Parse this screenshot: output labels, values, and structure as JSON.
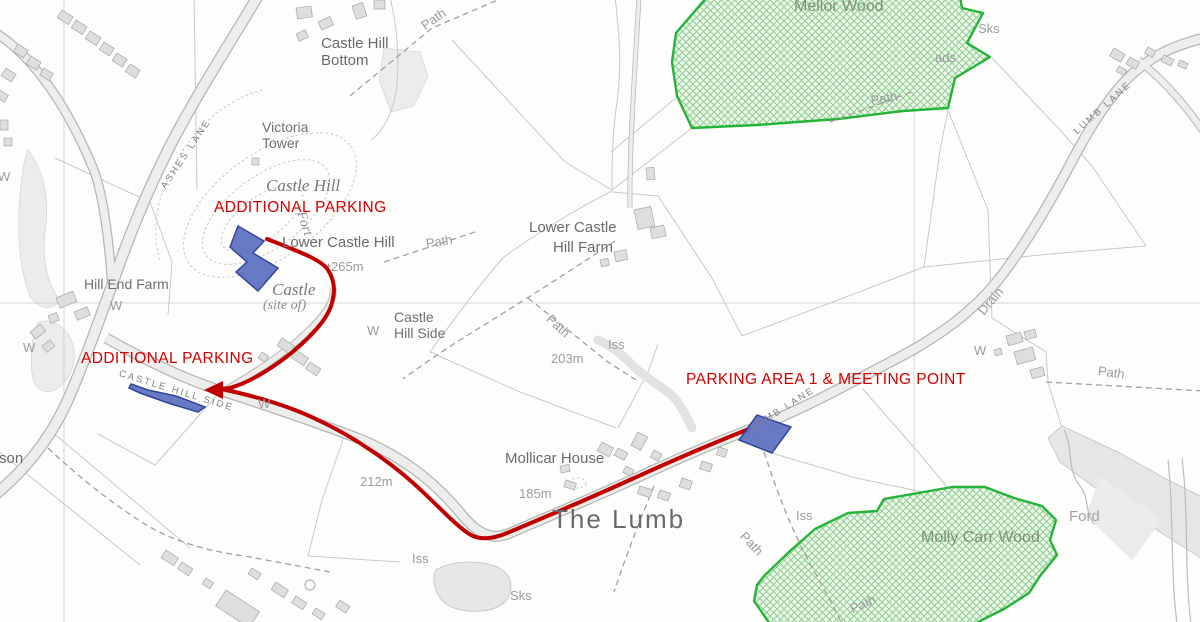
{
  "map": {
    "description": "OS-style walking map with marked parking areas and route",
    "colors": {
      "route_red": "#c00000",
      "annotation_red": "#d20000",
      "parking_fill": "#6273c2",
      "parking_stroke": "#2c3c96",
      "wood_border": "#25b33a",
      "wood_fill": "#e4f3dd",
      "wood_hatch": "#7ec983",
      "wood_text": "#7d917d",
      "road_casing": "#b5b5b3",
      "road_fill": "#ededeb",
      "field_line": "#c9c9c7",
      "grid_line": "#cbcbc9",
      "building_fill": "#dedede",
      "building_stroke": "#a7a7a5",
      "water_gray": "#e6e6e4"
    },
    "annotations": {
      "additional_parking_upper": "ADDITIONAL PARKING",
      "additional_parking_lower": "ADDITIONAL PARKING",
      "parking_area_1": "PARKING AREA 1 & MEETING POINT"
    },
    "labels": [
      {
        "t": "Castle Hill\nBottom",
        "x": 321,
        "y": 36,
        "c": "place2",
        "name": "label-castle-hill-bottom"
      },
      {
        "t": "Path",
        "x": 423,
        "y": 20,
        "r": -35,
        "c": "feat",
        "name": "label-path-top"
      },
      {
        "t": "Victoria\nTower",
        "x": 262,
        "y": 120,
        "c": "place",
        "name": "label-victoria-tower"
      },
      {
        "t": "Castle Hill",
        "x": 266,
        "y": 176,
        "c": "antiq",
        "name": "label-castle-hill"
      },
      {
        "t": "Fort",
        "x": 300,
        "y": 204,
        "r": 72,
        "c": "antiq-sm",
        "name": "label-fort"
      },
      {
        "t": "ADDITIONAL PARKING",
        "x": 214,
        "y": 199,
        "c": "red",
        "name": "annotation-additional-parking-upper"
      },
      {
        "t": "Lower Castle Hill",
        "x": 282,
        "y": 235,
        "c": "place2",
        "name": "label-lower-castle-hill"
      },
      {
        "t": "265m",
        "x": 331,
        "y": 260,
        "c": "elev",
        "name": "label-height-265m"
      },
      {
        "t": "Castle",
        "x": 272,
        "y": 280,
        "c": "antiq",
        "name": "label-castle-site"
      },
      {
        "t": "(site of)",
        "x": 263,
        "y": 298,
        "c": "antiq-sm",
        "name": "label-castle-site-of"
      },
      {
        "t": "Lower Castle",
        "x": 529,
        "y": 220,
        "c": "place2",
        "name": "label-lower-castle-hill-farm-line1"
      },
      {
        "t": "Hill Farm",
        "x": 553,
        "y": 240,
        "c": "place2",
        "name": "label-lower-castle-hill-farm-line2"
      },
      {
        "t": "Mellor Wood",
        "x": 794,
        "y": -2,
        "c": "wood",
        "name": "label-mellor-wood"
      },
      {
        "t": "Sks",
        "x": 978,
        "y": 22,
        "c": "feat",
        "name": "label-sks-top"
      },
      {
        "t": "ads",
        "x": 935,
        "y": 51,
        "c": "feat",
        "name": "label-ads-partial"
      },
      {
        "t": "Path",
        "x": 871,
        "y": 94,
        "r": -10,
        "c": "feat",
        "name": "label-path-mellor"
      },
      {
        "t": "LUMB LANE",
        "x": 1076,
        "y": 128,
        "r": -42,
        "c": "road",
        "name": "label-lumb-lane-upper"
      },
      {
        "t": "ASHES LANE",
        "x": 164,
        "y": 183,
        "r": -56,
        "c": "road",
        "name": "label-ashes-lane"
      },
      {
        "t": "Hill End Farm",
        "x": 84,
        "y": 277,
        "c": "place",
        "name": "label-hill-end-farm"
      },
      {
        "t": "W",
        "x": -2,
        "y": 170,
        "c": "feat",
        "name": "label-well-1"
      },
      {
        "t": "W",
        "x": 23,
        "y": 341,
        "c": "feat",
        "name": "label-well-2"
      },
      {
        "t": "W",
        "x": 110,
        "y": 299,
        "c": "feat",
        "name": "label-well-3"
      },
      {
        "t": "W",
        "x": 367,
        "y": 324,
        "c": "feat",
        "name": "label-well-4"
      },
      {
        "t": "W",
        "x": 258,
        "y": 397,
        "c": "feat",
        "name": "label-well-5"
      },
      {
        "t": "W",
        "x": 974,
        "y": 344,
        "c": "feat",
        "name": "label-well-6"
      },
      {
        "t": "Path",
        "x": 426,
        "y": 237,
        "r": -9,
        "c": "feat",
        "name": "label-path-mid"
      },
      {
        "t": "Path",
        "x": 548,
        "y": 310,
        "r": 43,
        "c": "feat",
        "name": "label-path-iss"
      },
      {
        "t": "Path",
        "x": 1098,
        "y": 364,
        "r": 8,
        "c": "feat",
        "name": "label-path-east"
      },
      {
        "t": "Path",
        "x": 742,
        "y": 527,
        "r": 47,
        "c": "feat",
        "name": "label-path-lumb"
      },
      {
        "t": "Path",
        "x": 851,
        "y": 603,
        "r": -25,
        "c": "feat",
        "name": "label-path-molly"
      },
      {
        "t": "Iss",
        "x": 608,
        "y": 338,
        "c": "feat",
        "name": "label-iss-1"
      },
      {
        "t": "Iss",
        "x": 412,
        "y": 552,
        "c": "feat",
        "name": "label-iss-2"
      },
      {
        "t": "Iss",
        "x": 796,
        "y": 509,
        "c": "feat",
        "name": "label-iss-3"
      },
      {
        "t": "Sks",
        "x": 510,
        "y": 589,
        "c": "feat",
        "name": "label-sks-bottom"
      },
      {
        "t": "203m",
        "x": 551,
        "y": 352,
        "c": "elev",
        "name": "label-height-203m"
      },
      {
        "t": "212m",
        "x": 360,
        "y": 475,
        "c": "elev",
        "name": "label-height-212m"
      },
      {
        "t": "185m",
        "x": 519,
        "y": 487,
        "c": "elev",
        "name": "label-height-185m"
      },
      {
        "t": "Mollicar House",
        "x": 505,
        "y": 451,
        "c": "place2",
        "name": "label-mollicar-house"
      },
      {
        "t": "The Lumb",
        "x": 552,
        "y": 505,
        "c": "big",
        "name": "label-the-lumb"
      },
      {
        "t": "PARKING AREA 1 & MEETING POINT",
        "x": 686,
        "y": 371,
        "c": "red",
        "name": "annotation-parking-area-1-meeting-point"
      },
      {
        "t": "ADDITIONAL PARKING",
        "x": 81,
        "y": 350,
        "c": "red",
        "name": "annotation-additional-parking-lower"
      },
      {
        "t": "CASTLE HILL SIDE",
        "x": 119,
        "y": 369,
        "r": 17,
        "c": "road",
        "name": "label-castle-hill-side-road"
      },
      {
        "t": "LUMB LANE",
        "x": 752,
        "y": 424,
        "r": -32,
        "c": "road",
        "name": "label-lumb-lane-lower"
      },
      {
        "t": "Castle\nHill Side",
        "x": 394,
        "y": 310,
        "c": "place",
        "name": "label-castle-hill-side"
      },
      {
        "t": "Molly Carr Wood",
        "x": 921,
        "y": 529,
        "c": "wood",
        "name": "label-molly-carr-wood"
      },
      {
        "t": "Ford",
        "x": 1069,
        "y": 509,
        "c": "feat2",
        "name": "label-ford"
      },
      {
        "t": "Drain",
        "x": 981,
        "y": 306,
        "r": -49,
        "c": "feat",
        "name": "label-drain"
      },
      {
        "t": "rson",
        "x": -6,
        "y": 451,
        "c": "place2",
        "name": "label-rson-partial"
      }
    ]
  }
}
